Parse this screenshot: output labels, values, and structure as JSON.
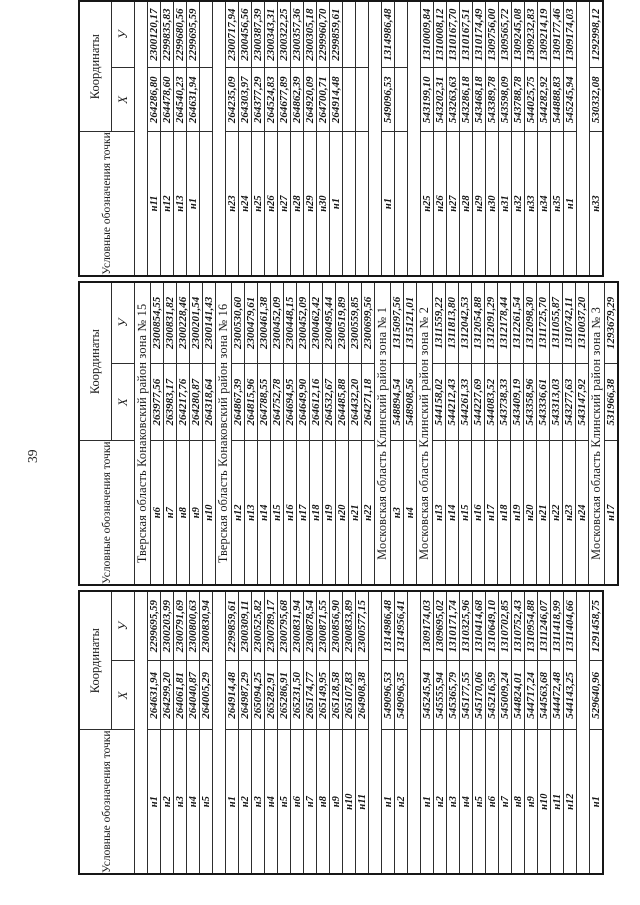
{
  "page": {
    "number": "39"
  },
  "table": {
    "header": {
      "point_label": "Условные обозначения точки",
      "coords_label": "Координаты",
      "x_label": "X",
      "y_label": "У"
    },
    "sections": [
      {
        "title": "Тверская область Конаковский район зона № 15",
        "rows": [
          {
            "g1": [
              "н1",
              "264631,94",
              "2299695,59"
            ],
            "g2": [
              "н6",
              "263977,56",
              "2300854,55"
            ],
            "g3": [
              "н11",
              "264286,80",
              "2300120,17"
            ]
          },
          {
            "g1": [
              "н2",
              "264299,20",
              "2300203,99"
            ],
            "g2": [
              "н7",
              "263983,17",
              "2300831,82"
            ],
            "g3": [
              "н12",
              "264478,60",
              "2299835,83"
            ]
          },
          {
            "g1": [
              "н3",
              "264061,81",
              "2300791,69"
            ],
            "g2": [
              "н8",
              "264217,76",
              "2300228,46"
            ],
            "g3": [
              "н13",
              "264540,23",
              "2299680,56"
            ]
          },
          {
            "g1": [
              "н4",
              "264040,87",
              "2300800,63"
            ],
            "g2": [
              "н9",
              "264280,87",
              "2300201,54"
            ],
            "g3": [
              "н1",
              "264631,94",
              "2299695,59"
            ]
          },
          {
            "g1": [
              "н5",
              "264005,29",
              "2300830,94"
            ],
            "g2": [
              "н10",
              "264318,64",
              "2300141,43"
            ],
            "g3": null
          }
        ]
      },
      {
        "title": "Тверская область Конаковский район зона № 16",
        "rows": [
          {
            "g1": [
              "н1",
              "264914,48",
              "2299859,61"
            ],
            "g2": [
              "н12",
              "264867,39",
              "2300530,60"
            ],
            "g3": [
              "н23",
              "264235,09",
              "2300717,94"
            ]
          },
          {
            "g1": [
              "н2",
              "264987,29",
              "2300309,11"
            ],
            "g2": [
              "н13",
              "264815,96",
              "2300479,61"
            ],
            "g3": [
              "н24",
              "264303,97",
              "2300456,56"
            ]
          },
          {
            "g1": [
              "н3",
              "265094,25",
              "2300525,82"
            ],
            "g2": [
              "н14",
              "264788,55",
              "2300461,38"
            ],
            "g3": [
              "н25",
              "264377,29",
              "2300387,39"
            ]
          },
          {
            "g1": [
              "н4",
              "265282,91",
              "2300789,17"
            ],
            "g2": [
              "н15",
              "264752,78",
              "2300452,09"
            ],
            "g3": [
              "н26",
              "264524,83",
              "2300343,31"
            ]
          },
          {
            "g1": [
              "н5",
              "265286,91",
              "2300795,68"
            ],
            "g2": [
              "н16",
              "264694,95",
              "2300448,15"
            ],
            "g3": [
              "н27",
              "264677,89",
              "2300322,25"
            ]
          },
          {
            "g1": [
              "н6",
              "265231,50",
              "2300831,94"
            ],
            "g2": [
              "н17",
              "264649,90",
              "2300452,09"
            ],
            "g3": [
              "н28",
              "264862,39",
              "2300357,36"
            ]
          },
          {
            "g1": [
              "н7",
              "265174,77",
              "2300878,54"
            ],
            "g2": [
              "н18",
              "264612,16",
              "2300462,42"
            ],
            "g3": [
              "н29",
              "264920,09",
              "2300305,18"
            ]
          },
          {
            "g1": [
              "н8",
              "265149,95",
              "2300871,55"
            ],
            "g2": [
              "н19",
              "264532,67",
              "2300495,44"
            ],
            "g3": [
              "н30",
              "264700,71",
              "2299960,70"
            ]
          },
          {
            "g1": [
              "н9",
              "265128,58",
              "2300856,90"
            ],
            "g2": [
              "н20",
              "264485,88",
              "2300519,89"
            ],
            "g3": [
              "н1",
              "264914,48",
              "2299859,61"
            ]
          },
          {
            "g1": [
              "н10",
              "265107,83",
              "2300833,89"
            ],
            "g2": [
              "н21",
              "264432,20",
              "2300559,85"
            ],
            "g3": null
          },
          {
            "g1": [
              "н11",
              "264908,38",
              "2300577,15"
            ],
            "g2": [
              "н22",
              "264271,18",
              "2300699,56"
            ],
            "g3": null
          }
        ]
      },
      {
        "title": "Московская область Клинский район зона № 1",
        "rows": [
          {
            "g1": [
              "н1",
              "549096,53",
              "1314986,48"
            ],
            "g2": [
              "н3",
              "548894,54",
              "1315097,56"
            ],
            "g3": [
              "н1",
              "549096,53",
              "1314986,48"
            ]
          },
          {
            "g1": [
              "н2",
              "549096,35",
              "1314956,41"
            ],
            "g2": [
              "н4",
              "548908,56",
              "1315121,01"
            ],
            "g3": null
          }
        ]
      },
      {
        "title": "Московская область Клинский район зона № 2",
        "rows": [
          {
            "g1": [
              "н1",
              "545245,94",
              "1309174,03"
            ],
            "g2": [
              "н13",
              "544158,02",
              "1311559,22"
            ],
            "g3": [
              "н25",
              "543199,10",
              "1310009,84"
            ]
          },
          {
            "g1": [
              "н2",
              "545555,94",
              "1309695,02"
            ],
            "g2": [
              "н14",
              "544212,43",
              "1311813,80"
            ],
            "g3": [
              "н26",
              "543202,31",
              "1310008,12"
            ]
          },
          {
            "g1": [
              "н3",
              "545365,79",
              "1310171,74"
            ],
            "g2": [
              "н15",
              "544261,33",
              "1312042,53"
            ],
            "g3": [
              "н27",
              "543263,63",
              "1310167,70"
            ]
          },
          {
            "g1": [
              "н4",
              "545177,55",
              "1310325,96"
            ],
            "g2": [
              "н16",
              "544227,69",
              "1312054,88"
            ],
            "g3": [
              "н28",
              "543286,18",
              "1310167,51"
            ]
          },
          {
            "g1": [
              "н5",
              "545170,06",
              "1310414,68"
            ],
            "g2": [
              "н17",
              "544083,52",
              "1312091,29"
            ],
            "g3": [
              "н29",
              "543468,18",
              "1310174,49"
            ]
          },
          {
            "g1": [
              "н6",
              "545216,59",
              "1310649,10"
            ],
            "g2": [
              "н18",
              "543738,33",
              "1312178,44"
            ],
            "g3": [
              "н30",
              "543389,78",
              "1309756,00"
            ]
          },
          {
            "g1": [
              "н7",
              "545009,24",
              "1310702,85"
            ],
            "g2": [
              "н19",
              "543409,19",
              "1312261,54"
            ],
            "g3": [
              "н31",
              "543598,09",
              "1309565,72"
            ]
          },
          {
            "g1": [
              "н8",
              "544824,01",
              "1310752,43"
            ],
            "g2": [
              "н20",
              "543358,96",
              "1312098,30"
            ],
            "g3": [
              "н32",
              "543788,78",
              "1309245,08"
            ]
          },
          {
            "g1": [
              "н9",
              "544717,24",
              "1310954,88"
            ],
            "g2": [
              "н21",
              "543336,61",
              "1311725,70"
            ],
            "g3": [
              "н33",
              "544025,75",
              "1309232,83"
            ]
          },
          {
            "g1": [
              "н10",
              "544563,68",
              "1311246,07"
            ],
            "g2": [
              "н22",
              "543313,03",
              "1311055,87"
            ],
            "g3": [
              "н34",
              "544282,92",
              "1309214,19"
            ]
          },
          {
            "g1": [
              "н11",
              "544472,48",
              "1311418,99"
            ],
            "g2": [
              "н23",
              "543277,63",
              "1310742,11"
            ],
            "g3": [
              "н35",
              "544888,83",
              "1309177,46"
            ]
          },
          {
            "g1": [
              "н12",
              "544143,25",
              "1311404,66"
            ],
            "g2": [
              "н24",
              "543147,92",
              "1310037,20"
            ],
            "g3": [
              "н1",
              "545245,94",
              "1309174,03"
            ]
          }
        ]
      },
      {
        "title": "Московская область Клинский район зона № 3",
        "rows": [
          {
            "g1": [
              "н1",
              "529640,96",
              "1291458,75"
            ],
            "g2": [
              "н17",
              "531966,38",
              "1293679,29"
            ],
            "g3": [
              "н33",
              "530332,08",
              "1292998,12"
            ]
          }
        ]
      }
    ]
  }
}
